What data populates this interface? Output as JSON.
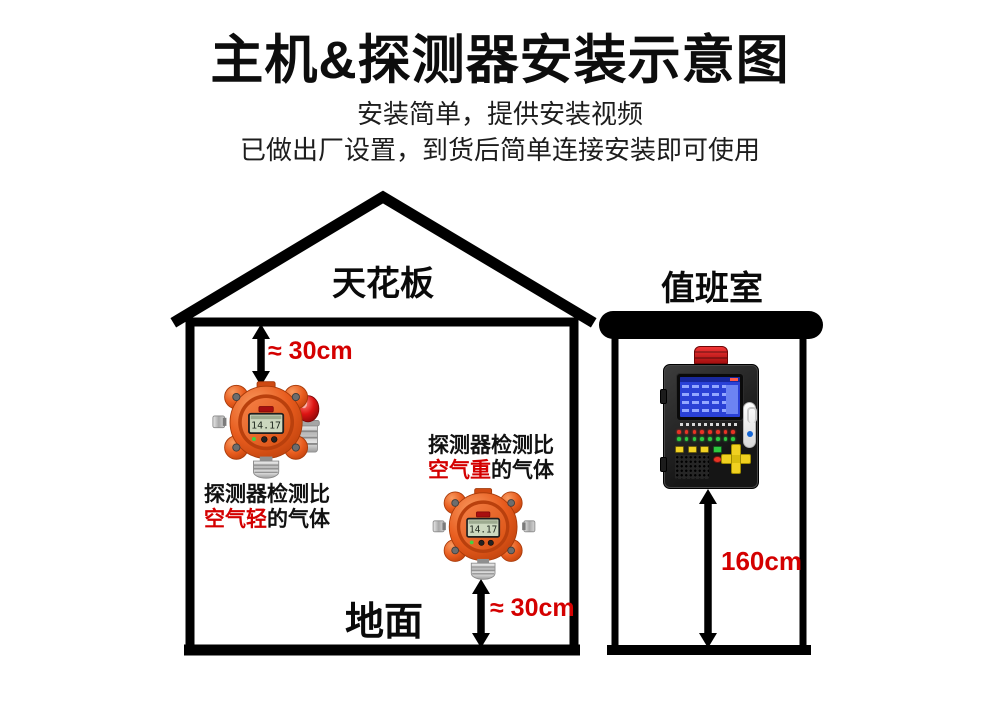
{
  "header": {
    "title": "主机&探测器安装示意图",
    "subtitle_line1": "安装简单，提供安装视频",
    "subtitle_line2": "已做出厂设置，到货后简单连接安装即可使用"
  },
  "house": {
    "ceiling_label": "天花板",
    "floor_label": "地面",
    "top_clearance_label": "≈ 30cm",
    "bottom_clearance_label": "≈ 30cm"
  },
  "duty_room": {
    "label": "值班室",
    "mount_height_label": "160cm"
  },
  "detectors": {
    "display_value": "14.17",
    "light_gas_caption": {
      "line1": "探测器检测比",
      "highlight": "空气轻",
      "suffix": "的气体"
    },
    "heavy_gas_caption": {
      "line1": "探测器检测比",
      "highlight": "空气重",
      "suffix": "的气体"
    }
  },
  "colors": {
    "accent_red": "#d40000",
    "detector_orange": "#e8581d",
    "line_black": "#000000"
  }
}
